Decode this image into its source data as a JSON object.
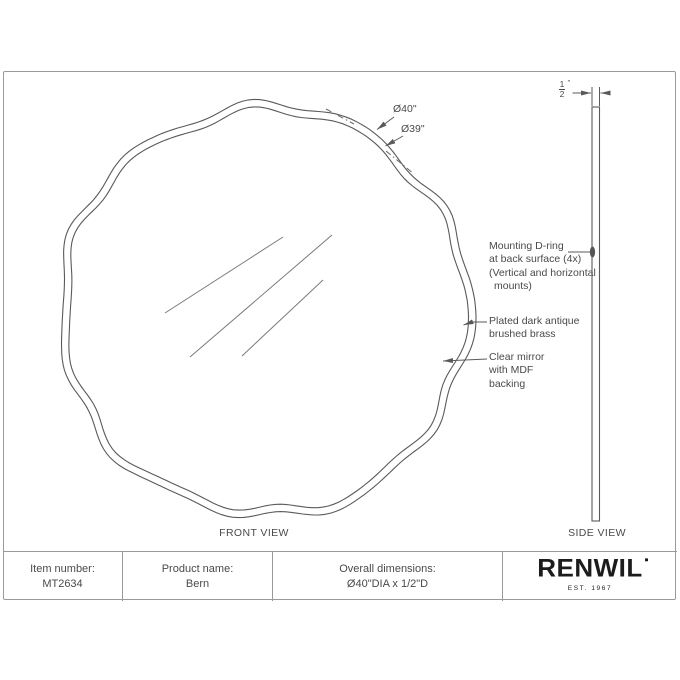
{
  "front_view": {
    "label": "FRONT VIEW",
    "dim_outer": "Ø40\"",
    "dim_inner": "Ø39\"",
    "annotations": {
      "dring": {
        "line1": "Mounting D-ring",
        "line2": "at back surface (4x)",
        "line3": "(Vertical and horizontal",
        "line4": "mounts)"
      },
      "brass": {
        "line1": "Plated dark antique",
        "line2": "brushed brass"
      },
      "mirror": {
        "line1": "Clear mirror",
        "line2": "with MDF",
        "line3": "backing"
      }
    }
  },
  "side_view": {
    "label": "SIDE VIEW",
    "thickness": {
      "numerator": "1",
      "denominator": "2",
      "unit": "\""
    }
  },
  "title_block": {
    "item": {
      "label": "Item number:",
      "value": "MT2634"
    },
    "product": {
      "label": "Product name:",
      "value": "Bern"
    },
    "dimensions": {
      "label": "Overall dimensions:",
      "value": "Ø40\"DIA x 1/2\"D"
    },
    "brand": {
      "name": "RENWIL",
      "established": "EST. 1967"
    }
  },
  "colors": {
    "line": "#5a5a5a",
    "text": "#4a4a4a",
    "frame": "#9a9a9a",
    "brand": "#1c1c1c"
  }
}
